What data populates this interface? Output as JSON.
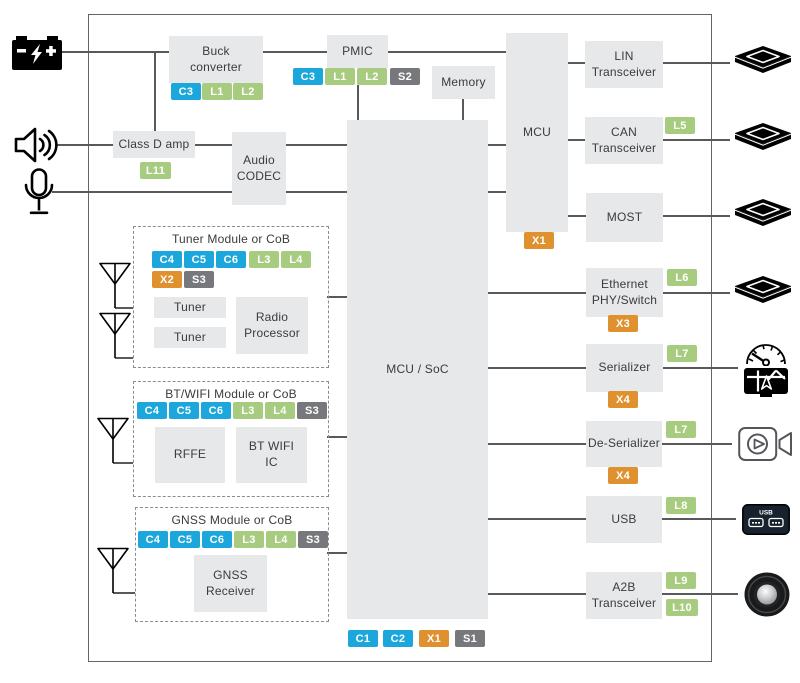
{
  "colors": {
    "cyan": "#1BA6DC",
    "green": "#A8CC7F",
    "orange": "#E0912F",
    "gray": "#77787B",
    "line": "#58595B",
    "boxFill": "#E7E8E9",
    "text": "#3B3B3D"
  },
  "diagram": {
    "border": {
      "x": 88,
      "y": 14,
      "w": 622,
      "h": 646
    },
    "blocks": [
      {
        "name": "buck-converter",
        "label": "Buck\nconverter",
        "x": 169,
        "y": 36,
        "w": 94,
        "h": 47
      },
      {
        "name": "pmic",
        "label": "PMIC",
        "x": 327,
        "y": 35,
        "w": 61,
        "h": 33
      },
      {
        "name": "memory",
        "label": "Memory",
        "x": 432,
        "y": 66,
        "w": 63,
        "h": 33
      },
      {
        "name": "mcu",
        "label": "MCU",
        "x": 506,
        "y": 33,
        "w": 62,
        "h": 199
      },
      {
        "name": "class-d-amp",
        "label": "Class D amp",
        "x": 113,
        "y": 131,
        "w": 82,
        "h": 27
      },
      {
        "name": "audio-codec",
        "label": "Audio\nCODEC",
        "x": 232,
        "y": 132,
        "w": 54,
        "h": 73
      },
      {
        "name": "mcu-soc",
        "label": "MCU / SoC",
        "x": 347,
        "y": 120,
        "w": 141,
        "h": 499
      },
      {
        "name": "lin-transceiver",
        "label": "LIN\nTransceiver",
        "x": 585,
        "y": 41,
        "w": 78,
        "h": 47
      },
      {
        "name": "can-transceiver",
        "label": "CAN\nTransceiver",
        "x": 585,
        "y": 117,
        "w": 78,
        "h": 47
      },
      {
        "name": "most",
        "label": "MOST",
        "x": 586,
        "y": 193,
        "w": 77,
        "h": 49
      },
      {
        "name": "ethernet-phy-switch",
        "label": "Ethernet\nPHY/Switch",
        "x": 586,
        "y": 268,
        "w": 77,
        "h": 49
      },
      {
        "name": "serializer",
        "label": "Serializer",
        "x": 586,
        "y": 344,
        "w": 77,
        "h": 48
      },
      {
        "name": "de-serializer",
        "label": "De-Serializer",
        "x": 586,
        "y": 421,
        "w": 76,
        "h": 46
      },
      {
        "name": "usb",
        "label": "USB",
        "x": 586,
        "y": 496,
        "w": 76,
        "h": 47
      },
      {
        "name": "a2b-transceiver",
        "label": "A2B\nTransceiver",
        "x": 586,
        "y": 572,
        "w": 76,
        "h": 47
      },
      {
        "name": "tuner-1",
        "label": "Tuner",
        "x": 154,
        "y": 297,
        "w": 72,
        "h": 21
      },
      {
        "name": "tuner-2",
        "label": "Tuner",
        "x": 154,
        "y": 327,
        "w": 72,
        "h": 21
      },
      {
        "name": "radio-processor",
        "label": "Radio\nProcessor",
        "x": 236,
        "y": 297,
        "w": 72,
        "h": 57
      },
      {
        "name": "rffe",
        "label": "RFFE",
        "x": 155,
        "y": 427,
        "w": 70,
        "h": 56
      },
      {
        "name": "bt-wifi-ic",
        "label": "BT WIFI\nIC",
        "x": 236,
        "y": 427,
        "w": 71,
        "h": 56
      },
      {
        "name": "gnss-receiver",
        "label": "GNSS\nReceiver",
        "x": 194,
        "y": 555,
        "w": 73,
        "h": 57
      }
    ],
    "modules": [
      {
        "name": "tuner-module",
        "title": "Tuner Module or CoB",
        "x": 133,
        "y": 226,
        "w": 194,
        "h": 140
      },
      {
        "name": "bt-wifi-module",
        "title": "BT/WIFI Module or CoB",
        "x": 133,
        "y": 381,
        "w": 194,
        "h": 114
      },
      {
        "name": "gnss-module",
        "title": "GNSS Module or CoB",
        "x": 135,
        "y": 507,
        "w": 192,
        "h": 113
      }
    ],
    "chips": [
      {
        "label": "C3",
        "color": "cyan",
        "x": 171,
        "y": 83
      },
      {
        "label": "L1",
        "color": "green",
        "x": 202,
        "y": 83
      },
      {
        "label": "L2",
        "color": "green",
        "x": 233,
        "y": 83
      },
      {
        "label": "C3",
        "color": "cyan",
        "x": 293,
        "y": 68
      },
      {
        "label": "L1",
        "color": "green",
        "x": 325,
        "y": 68
      },
      {
        "label": "L2",
        "color": "green",
        "x": 357,
        "y": 68
      },
      {
        "label": "S2",
        "color": "gray",
        "x": 390,
        "y": 68
      },
      {
        "label": "L11",
        "color": "green",
        "x": 140,
        "y": 162,
        "w": 31
      },
      {
        "label": "X1",
        "color": "orange",
        "x": 524,
        "y": 232
      },
      {
        "label": "C4",
        "color": "cyan",
        "x": 152,
        "y": 251
      },
      {
        "label": "C5",
        "color": "cyan",
        "x": 184,
        "y": 251
      },
      {
        "label": "C6",
        "color": "cyan",
        "x": 216,
        "y": 251
      },
      {
        "label": "L3",
        "color": "green",
        "x": 249,
        "y": 251
      },
      {
        "label": "L4",
        "color": "green",
        "x": 281,
        "y": 251
      },
      {
        "label": "X2",
        "color": "orange",
        "x": 152,
        "y": 271
      },
      {
        "label": "S3",
        "color": "gray",
        "x": 184,
        "y": 271
      },
      {
        "label": "C4",
        "color": "cyan",
        "x": 137,
        "y": 402
      },
      {
        "label": "C5",
        "color": "cyan",
        "x": 169,
        "y": 402
      },
      {
        "label": "C6",
        "color": "cyan",
        "x": 201,
        "y": 402
      },
      {
        "label": "L3",
        "color": "green",
        "x": 233,
        "y": 402
      },
      {
        "label": "L4",
        "color": "green",
        "x": 265,
        "y": 402
      },
      {
        "label": "S3",
        "color": "gray",
        "x": 297,
        "y": 402
      },
      {
        "label": "C4",
        "color": "cyan",
        "x": 138,
        "y": 531
      },
      {
        "label": "C5",
        "color": "cyan",
        "x": 170,
        "y": 531
      },
      {
        "label": "C6",
        "color": "cyan",
        "x": 202,
        "y": 531
      },
      {
        "label": "L3",
        "color": "green",
        "x": 234,
        "y": 531
      },
      {
        "label": "L4",
        "color": "green",
        "x": 266,
        "y": 531
      },
      {
        "label": "S3",
        "color": "gray",
        "x": 298,
        "y": 531
      },
      {
        "label": "L5",
        "color": "green",
        "x": 665,
        "y": 117
      },
      {
        "label": "L6",
        "color": "green",
        "x": 667,
        "y": 269
      },
      {
        "label": "X3",
        "color": "orange",
        "x": 608,
        "y": 315
      },
      {
        "label": "L7",
        "color": "green",
        "x": 667,
        "y": 345
      },
      {
        "label": "X4",
        "color": "orange",
        "x": 608,
        "y": 391
      },
      {
        "label": "L7",
        "color": "green",
        "x": 666,
        "y": 421
      },
      {
        "label": "X4",
        "color": "orange",
        "x": 608,
        "y": 467
      },
      {
        "label": "L8",
        "color": "green",
        "x": 666,
        "y": 497
      },
      {
        "label": "L9",
        "color": "green",
        "x": 666,
        "y": 572
      },
      {
        "label": "L10",
        "color": "green",
        "x": 666,
        "y": 599,
        "w": 32
      },
      {
        "label": "C1",
        "color": "cyan",
        "x": 348,
        "y": 630
      },
      {
        "label": "C2",
        "color": "cyan",
        "x": 383,
        "y": 630
      },
      {
        "label": "X1",
        "color": "orange",
        "x": 419,
        "y": 630
      },
      {
        "label": "S1",
        "color": "gray",
        "x": 455,
        "y": 630
      }
    ],
    "lines": [
      {
        "name": "battery-to-buck",
        "x1": 60,
        "y1": 52,
        "x2": 169,
        "y2": 52
      },
      {
        "name": "battery-branch-to-amp",
        "x1": 155,
        "y1": 52,
        "x2": 155,
        "y2": 131
      },
      {
        "name": "buck-to-pmic",
        "x1": 263,
        "y1": 52,
        "x2": 327,
        "y2": 52
      },
      {
        "name": "pmic-to-mcu",
        "x1": 388,
        "y1": 52,
        "x2": 506,
        "y2": 52
      },
      {
        "name": "pmic-to-mcusoc",
        "x1": 358,
        "y1": 85,
        "x2": 358,
        "y2": 120
      },
      {
        "name": "memory-to-mcusoc",
        "x1": 463,
        "y1": 99,
        "x2": 463,
        "y2": 120
      },
      {
        "name": "speaker-to-amp",
        "x1": 57,
        "y1": 145,
        "x2": 113,
        "y2": 145
      },
      {
        "name": "amp-to-codec",
        "x1": 195,
        "y1": 145,
        "x2": 232,
        "y2": 145
      },
      {
        "name": "codec-to-mcusoc-1",
        "x1": 286,
        "y1": 145,
        "x2": 347,
        "y2": 145
      },
      {
        "name": "mcusoc-to-mcu-1",
        "x1": 488,
        "y1": 145,
        "x2": 506,
        "y2": 145
      },
      {
        "name": "mic-to-codec",
        "x1": 52,
        "y1": 192,
        "x2": 232,
        "y2": 192
      },
      {
        "name": "codec-to-mcusoc-2",
        "x1": 286,
        "y1": 192,
        "x2": 347,
        "y2": 192
      },
      {
        "name": "mcusoc-to-mcu-2",
        "x1": 488,
        "y1": 192,
        "x2": 506,
        "y2": 192
      },
      {
        "name": "mcu-to-lin",
        "x1": 568,
        "y1": 63,
        "x2": 585,
        "y2": 63
      },
      {
        "name": "lin-to-ecu",
        "x1": 663,
        "y1": 63,
        "x2": 730,
        "y2": 63
      },
      {
        "name": "mcu-to-can",
        "x1": 568,
        "y1": 140,
        "x2": 585,
        "y2": 140
      },
      {
        "name": "can-to-ecu",
        "x1": 663,
        "y1": 140,
        "x2": 730,
        "y2": 140
      },
      {
        "name": "mcu-to-most",
        "x1": 568,
        "y1": 216,
        "x2": 586,
        "y2": 216
      },
      {
        "name": "most-to-ecu",
        "x1": 663,
        "y1": 216,
        "x2": 730,
        "y2": 216
      },
      {
        "name": "mcusoc-to-ethernet",
        "x1": 488,
        "y1": 293,
        "x2": 586,
        "y2": 293
      },
      {
        "name": "ethernet-to-ecu",
        "x1": 663,
        "y1": 293,
        "x2": 730,
        "y2": 293
      },
      {
        "name": "mcusoc-to-serializer",
        "x1": 488,
        "y1": 368,
        "x2": 586,
        "y2": 368
      },
      {
        "name": "serializer-to-display",
        "x1": 663,
        "y1": 368,
        "x2": 738,
        "y2": 368
      },
      {
        "name": "mcusoc-to-deserializer",
        "x1": 488,
        "y1": 444,
        "x2": 586,
        "y2": 444
      },
      {
        "name": "deserializer-to-camera",
        "x1": 662,
        "y1": 444,
        "x2": 732,
        "y2": 444
      },
      {
        "name": "mcusoc-to-usb",
        "x1": 488,
        "y1": 519,
        "x2": 586,
        "y2": 519
      },
      {
        "name": "usb-to-port",
        "x1": 662,
        "y1": 519,
        "x2": 736,
        "y2": 519
      },
      {
        "name": "mcusoc-to-a2b",
        "x1": 488,
        "y1": 594,
        "x2": 586,
        "y2": 594
      },
      {
        "name": "a2b-to-speaker",
        "x1": 662,
        "y1": 594,
        "x2": 738,
        "y2": 594
      },
      {
        "name": "tuner-to-mcusoc",
        "x1": 327,
        "y1": 297,
        "x2": 347,
        "y2": 297
      },
      {
        "name": "btwifi-to-mcusoc",
        "x1": 327,
        "y1": 437,
        "x2": 347,
        "y2": 437
      },
      {
        "name": "gnss-to-mcusoc",
        "x1": 327,
        "y1": 553,
        "x2": 347,
        "y2": 553
      },
      {
        "name": "antenna1-link",
        "x1": 115,
        "y1": 308,
        "x2": 133,
        "y2": 308
      },
      {
        "name": "antenna2-link",
        "x1": 115,
        "y1": 358,
        "x2": 133,
        "y2": 358
      },
      {
        "name": "antenna3-link",
        "x1": 113,
        "y1": 463,
        "x2": 133,
        "y2": 463
      },
      {
        "name": "antenna4-link",
        "x1": 113,
        "y1": 593,
        "x2": 135,
        "y2": 593
      }
    ],
    "icons": [
      {
        "name": "car-battery-icon",
        "icon": "battery",
        "x": 12,
        "y": 36,
        "w": 50,
        "h": 34
      },
      {
        "name": "speaker-icon",
        "icon": "speaker",
        "x": 14,
        "y": 126,
        "w": 44,
        "h": 38
      },
      {
        "name": "microphone-icon",
        "icon": "mic",
        "x": 24,
        "y": 168,
        "w": 30,
        "h": 48
      },
      {
        "name": "antenna-icon-tuner-1",
        "icon": "antenna",
        "x": 98,
        "y": 262,
        "w": 34,
        "h": 46
      },
      {
        "name": "antenna-icon-tuner-2",
        "icon": "antenna",
        "x": 98,
        "y": 312,
        "w": 34,
        "h": 46
      },
      {
        "name": "antenna-icon-btwifi",
        "icon": "antenna",
        "x": 96,
        "y": 417,
        "w": 34,
        "h": 46
      },
      {
        "name": "antenna-icon-gnss",
        "icon": "antenna",
        "x": 96,
        "y": 547,
        "w": 34,
        "h": 46
      },
      {
        "name": "ecu-module-icon-lin",
        "icon": "ecu",
        "x": 735,
        "y": 46,
        "w": 56,
        "h": 34
      },
      {
        "name": "ecu-module-icon-can",
        "icon": "ecu",
        "x": 735,
        "y": 123,
        "w": 56,
        "h": 34
      },
      {
        "name": "ecu-module-icon-most",
        "icon": "ecu",
        "x": 735,
        "y": 199,
        "w": 56,
        "h": 34
      },
      {
        "name": "ecu-module-icon-ethernet",
        "icon": "ecu",
        "x": 735,
        "y": 276,
        "w": 56,
        "h": 34
      },
      {
        "name": "gauge-icon",
        "icon": "gauge",
        "x": 744,
        "y": 340,
        "w": 44,
        "h": 26
      },
      {
        "name": "nav-display-icon",
        "icon": "nav",
        "x": 743,
        "y": 368,
        "w": 46,
        "h": 31
      },
      {
        "name": "video-camera-icon",
        "icon": "camera",
        "x": 738,
        "y": 426,
        "w": 56,
        "h": 36
      },
      {
        "name": "usb-port-icon",
        "icon": "usbport",
        "x": 742,
        "y": 504,
        "w": 48,
        "h": 31
      },
      {
        "name": "subwoofer-icon",
        "icon": "woofer",
        "x": 744,
        "y": 572,
        "w": 46,
        "h": 45
      }
    ]
  }
}
